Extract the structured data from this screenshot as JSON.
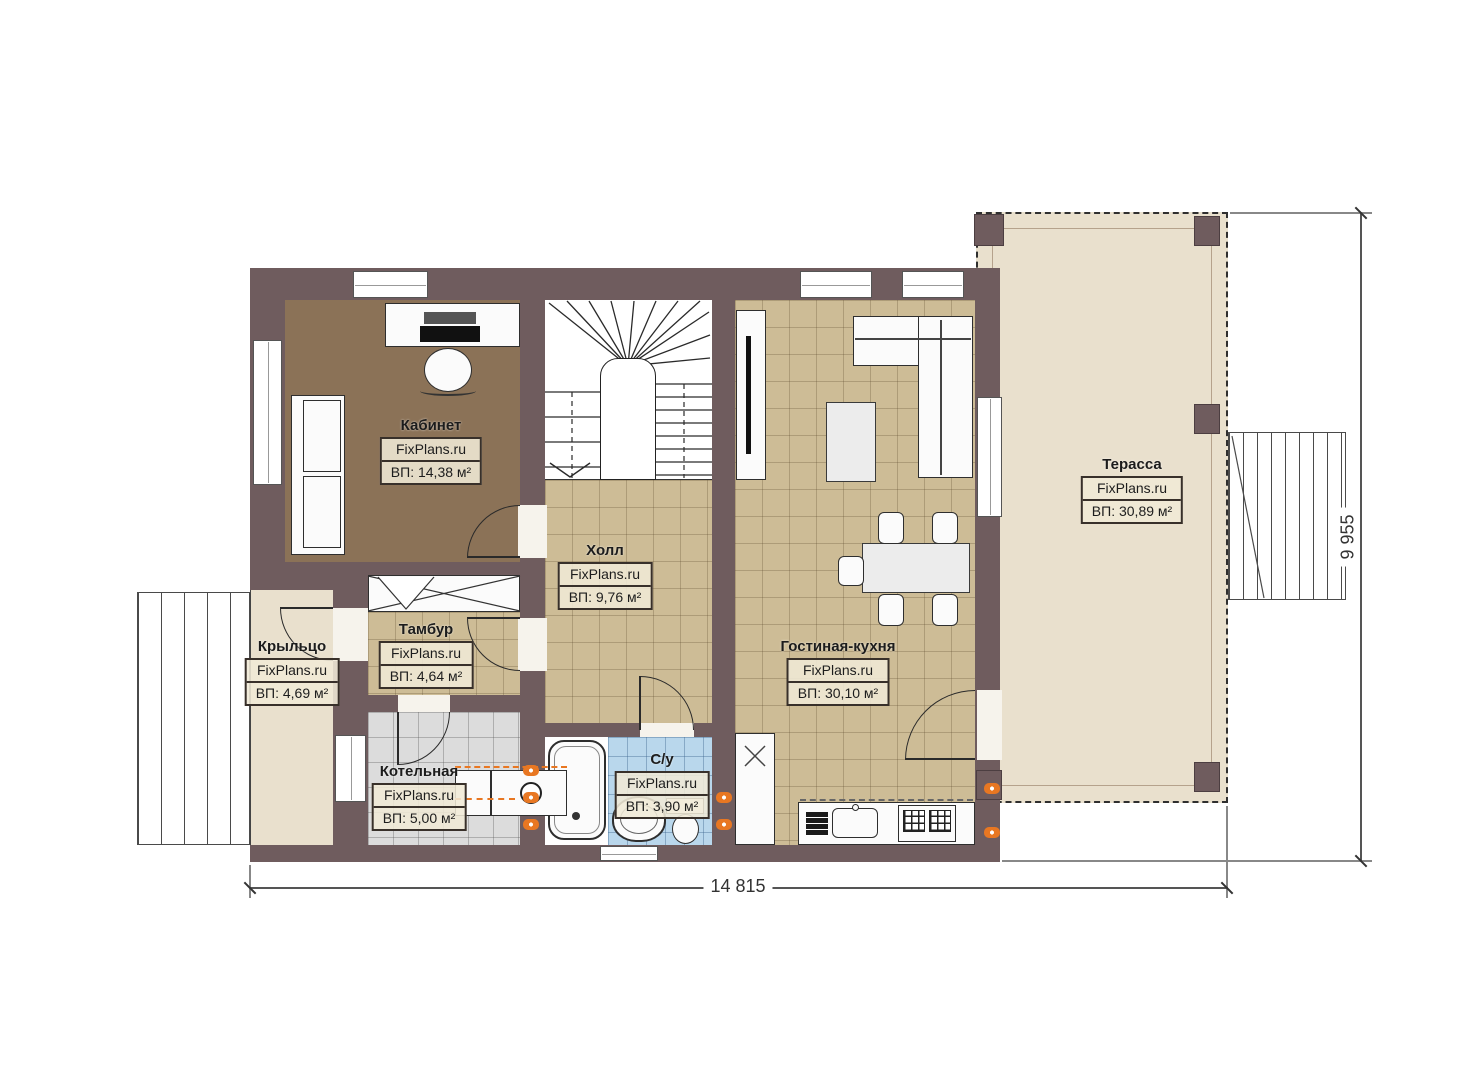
{
  "watermark": "FixPlans.ru",
  "rooms": [
    {
      "key": "kabinet",
      "name": "Кабинет",
      "area": "ВП: 14,38 м²"
    },
    {
      "key": "holl",
      "name": "Холл",
      "area": "ВП: 9,76 м²"
    },
    {
      "key": "tambur",
      "name": "Тамбур",
      "area": "ВП: 4,64 м²"
    },
    {
      "key": "krylco",
      "name": "Крыльцо",
      "area": "ВП: 4,69 м²"
    },
    {
      "key": "kotelnaya",
      "name": "Котельная",
      "area": "ВП: 5,00 м²"
    },
    {
      "key": "su",
      "name": "С/у",
      "area": "ВП: 3,90 м²"
    },
    {
      "key": "gostinaya_kuhnya",
      "name": "Гостиная-кухня",
      "area": "ВП: 30,10 м²"
    },
    {
      "key": "terassa",
      "name": "Терасса",
      "area": "ВП: 30,89 м²"
    }
  ],
  "dimensions": {
    "width": "14 815",
    "height": "9 955"
  },
  "colors": {
    "wall": "#6f5c5e",
    "office_floor": "#8b7257",
    "tile_tan": "#cdbc96",
    "tile_gray": "#dcdcdc",
    "tile_blue": "#b9d7ec",
    "terrace_floor": "#e9e0cd",
    "radiator_orange": "#e87722"
  }
}
